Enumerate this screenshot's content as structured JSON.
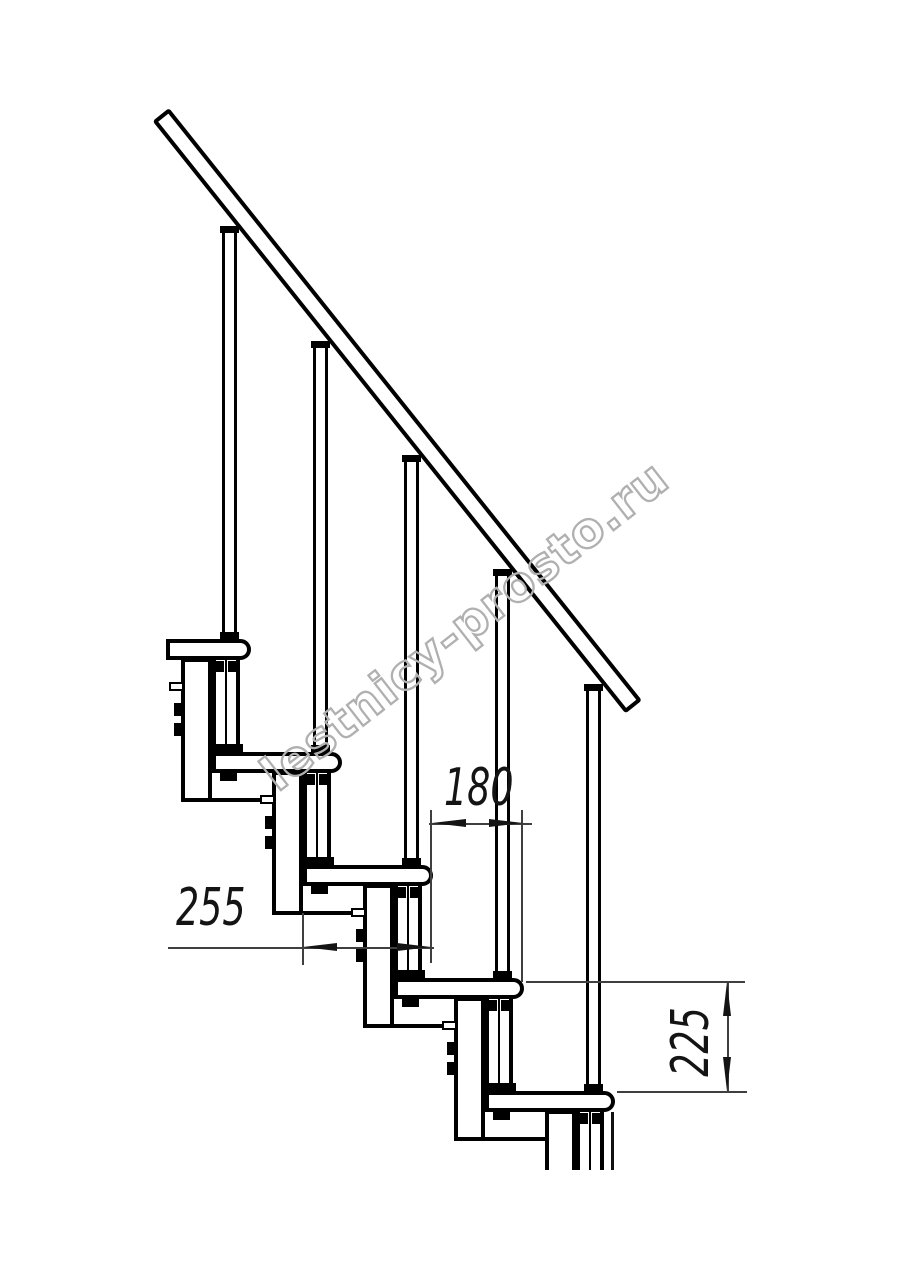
{
  "figure": {
    "watermark": "lestnicy-prosto.ru",
    "kind": "modular-staircase-side-view-technical-drawing",
    "treads_visible": 5,
    "balusters_visible": 5
  },
  "dimensions": {
    "going": "180",
    "tread_depth": "255",
    "rise": "225"
  }
}
